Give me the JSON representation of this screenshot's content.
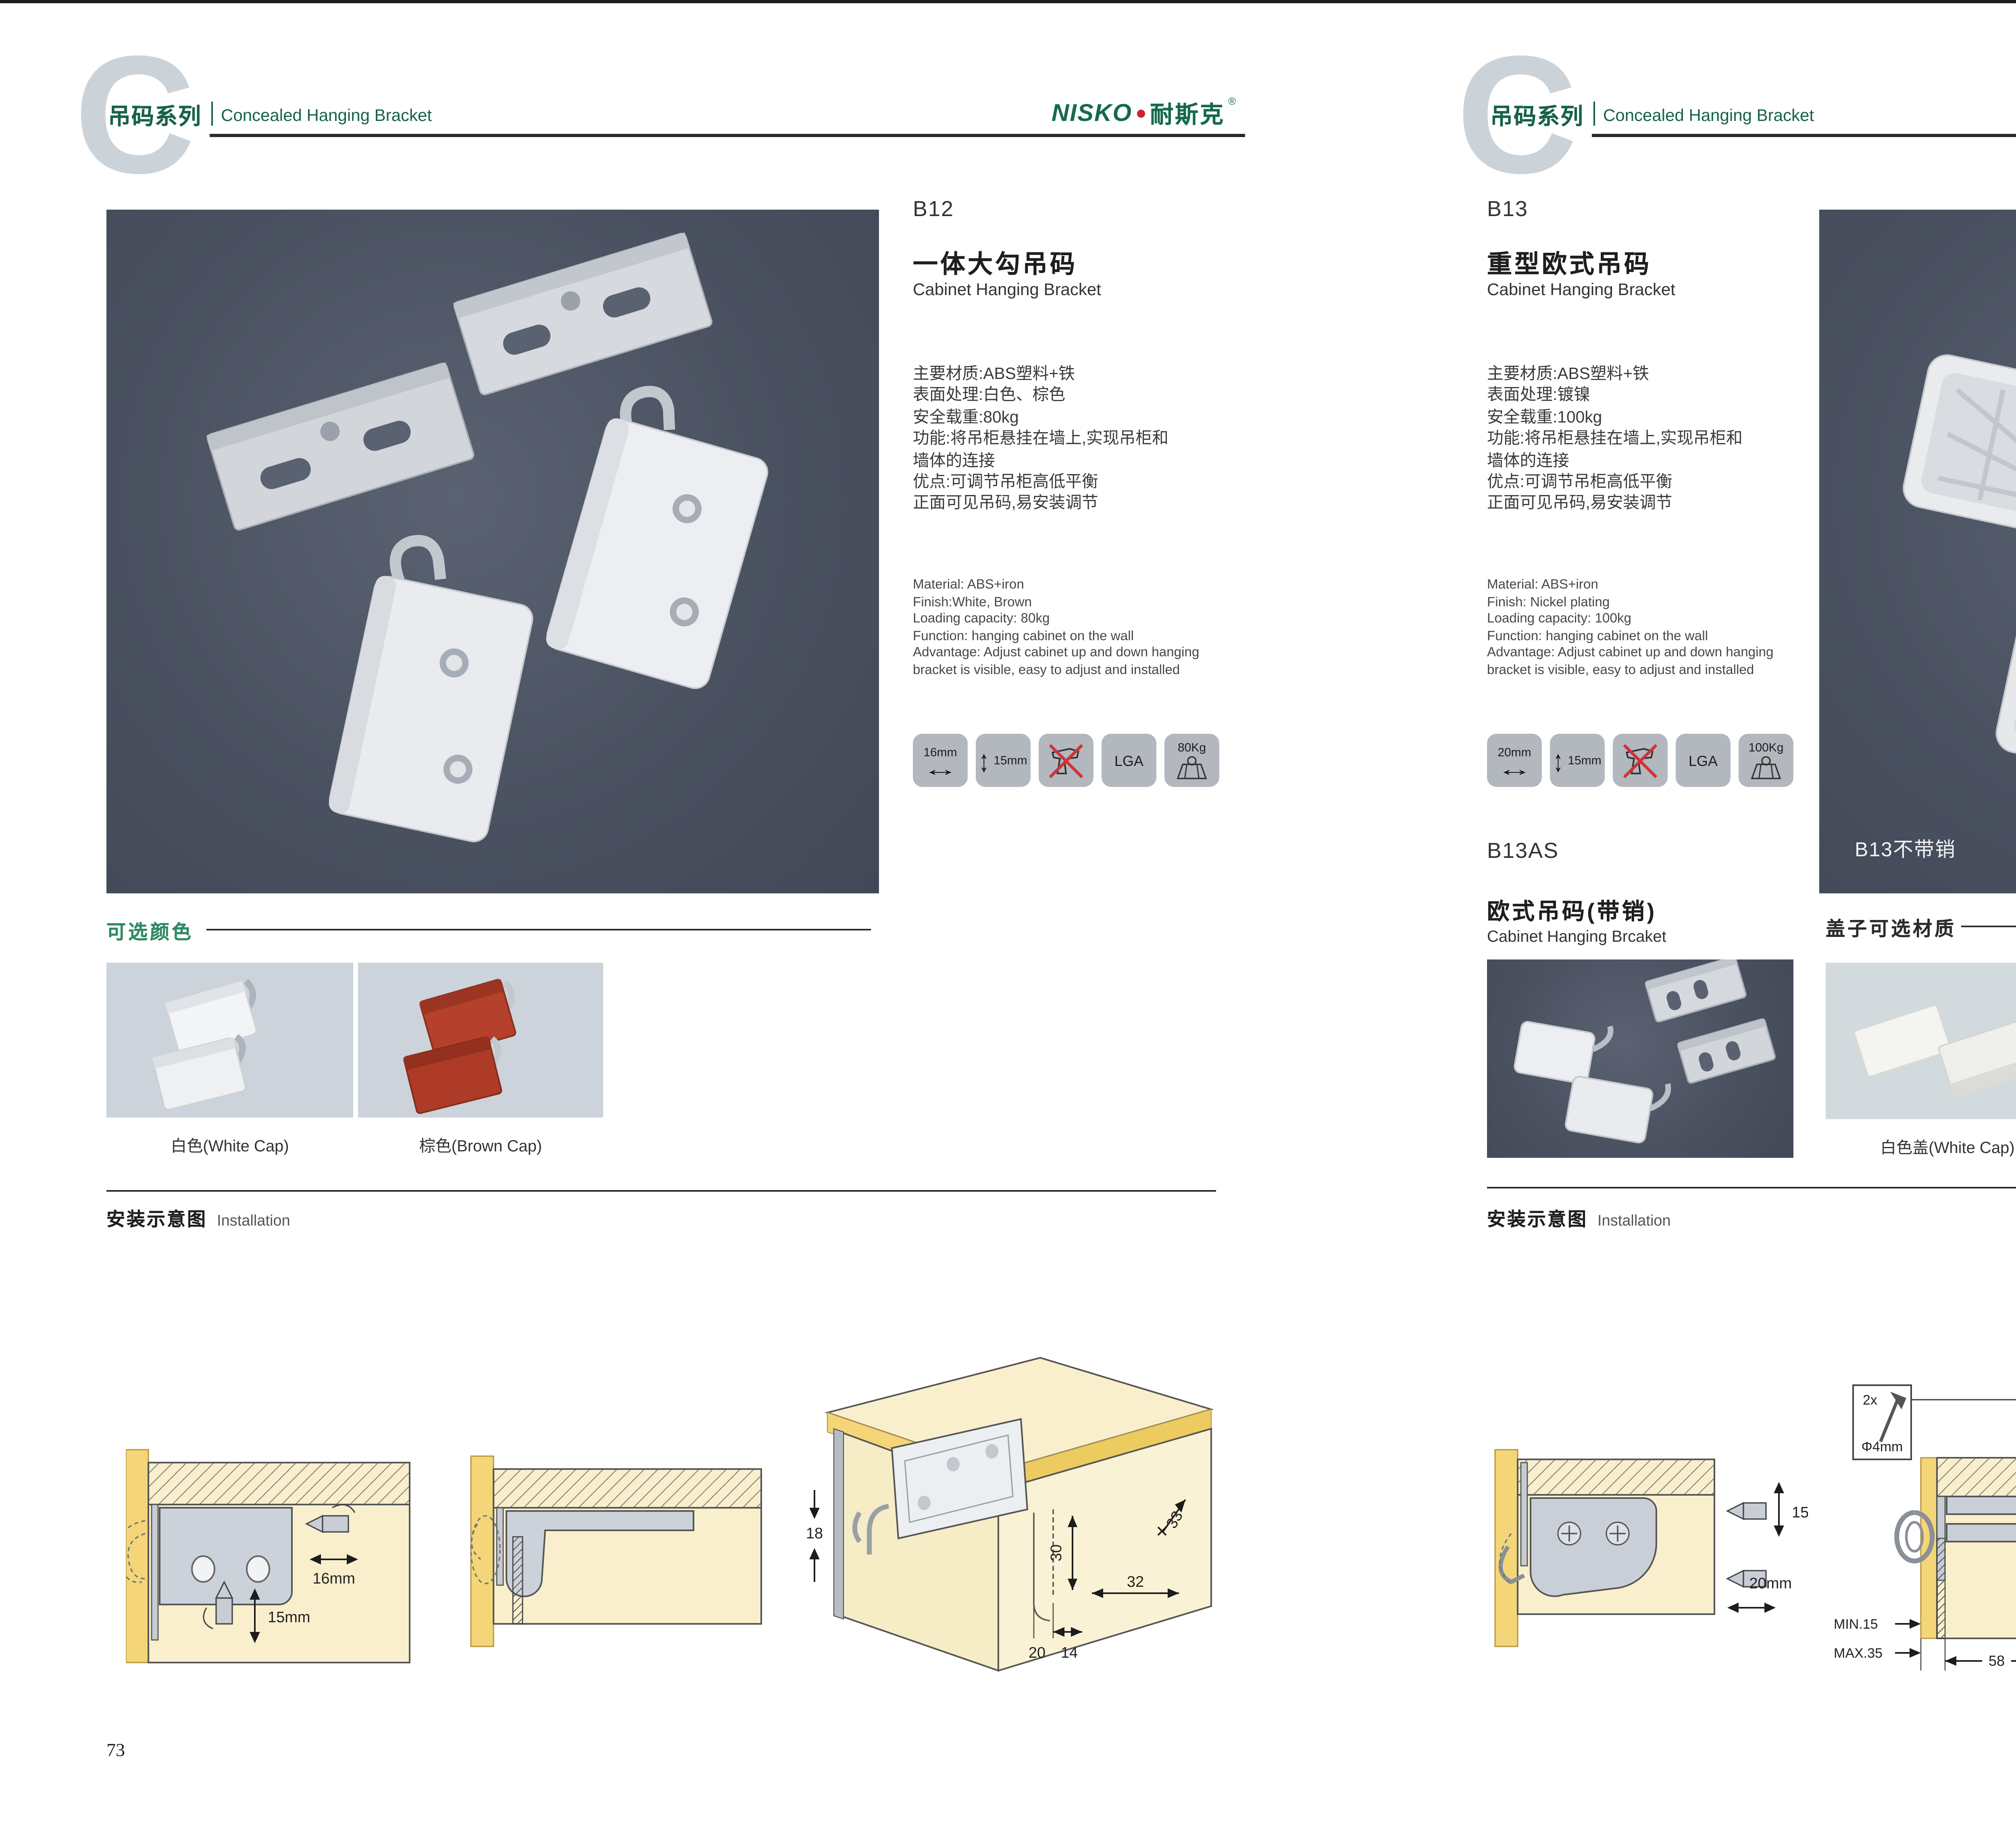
{
  "shared": {
    "series_cn": "吊码系列",
    "series_en": "Concealed Hanging Bracket",
    "brand_en": "NISKO",
    "brand_cn": "耐斯克",
    "brand_reg": "®",
    "watermark_letter": "C",
    "install_title_cn": "安装示意图",
    "install_title_en": "Installation"
  },
  "left": {
    "page_number": "73",
    "product": {
      "code": "B12",
      "name_cn": "一体大勾吊码",
      "name_en": "Cabinet Hanging Bracket",
      "specs_cn": [
        "主要材质:ABS塑料+铁",
        "表面处理:白色、棕色",
        "安全载重:80kg",
        "功能:将吊柜悬挂在墙上,实现吊柜和",
        "墙体的连接",
        "优点:可调节吊柜高低平衡",
        "正面可见吊码,易安装调节"
      ],
      "specs_en": [
        "Material: ABS+iron",
        "Finish:White, Brown",
        "Loading capacity: 80kg",
        "Function: hanging cabinet on the wall",
        "Advantage: Adjust cabinet up and down hanging",
        "bracket is visible, easy to adjust and installed"
      ],
      "icons": {
        "w": "16mm",
        "h": "15mm",
        "lga": "LGA",
        "load": "80Kg"
      }
    },
    "colors": {
      "title": "可选颜色",
      "opt1": "白色(White Cap)",
      "opt2": "棕色(Brown Cap)"
    },
    "install": {
      "d1": {
        "w": "16mm",
        "h": "15mm"
      },
      "d3": {
        "a": "18",
        "b": "33",
        "c": "30",
        "d": "32",
        "e": "20",
        "f": "14"
      }
    }
  },
  "right": {
    "page_number": "74",
    "product": {
      "code": "B13",
      "name_cn": "重型欧式吊码",
      "name_en": "Cabinet Hanging Bracket",
      "photo_label": "B13不带销",
      "specs_cn": [
        "主要材质:ABS塑料+铁",
        "表面处理:镀镍",
        "安全载重:100kg",
        "功能:将吊柜悬挂在墙上,实现吊柜和",
        "墙体的连接",
        "优点:可调节吊柜高低平衡",
        "正面可见吊码,易安装调节"
      ],
      "specs_en": [
        "Material: ABS+iron",
        "Finish: Nickel plating",
        "Loading capacity: 100kg",
        "Function: hanging cabinet on the wall",
        "Advantage: Adjust cabinet up and down hanging",
        "bracket is visible, easy to adjust and installed"
      ],
      "icons": {
        "w": "20mm",
        "h": "15mm",
        "lga": "LGA",
        "load": "100Kg"
      }
    },
    "sub_product": {
      "code": "B13AS",
      "name_cn": "欧式吊码(带销)",
      "name_en": "Cabinet Hanging Brcaket"
    },
    "covers": {
      "title": "盖子可选材质",
      "opt1": "白色盖(White Cap)",
      "opt2": "灰色盖(Gray Cap)"
    },
    "install": {
      "d1": {
        "h": "15mm",
        "w": "20mm"
      },
      "d2": {
        "qty": "2x",
        "dia": "Φ4mm",
        "a": "18",
        "min": "MIN.15",
        "max": "MAX.35",
        "b": "58"
      },
      "d3": {
        "a": "16",
        "b": "40",
        "r": "RMAX4",
        "c": "19",
        "d": "18",
        "e": "32"
      }
    }
  }
}
